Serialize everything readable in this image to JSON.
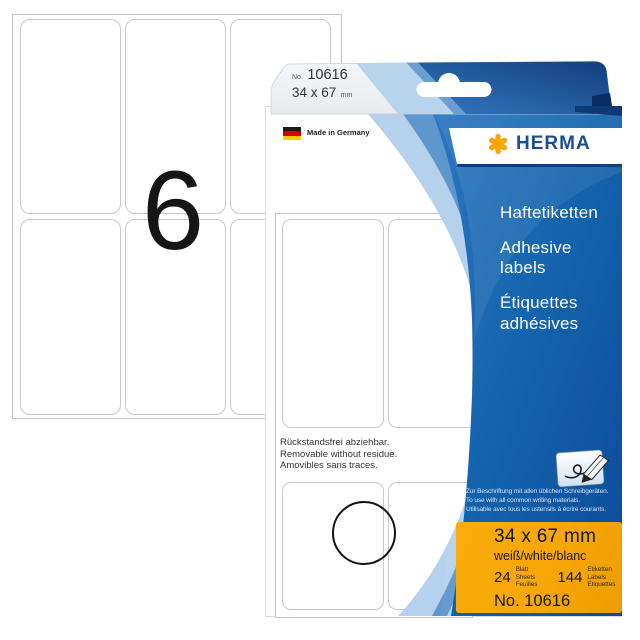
{
  "product": {
    "brand": "HERMA",
    "sheet_label_count": "6",
    "tab": {
      "no_prefix": "No.",
      "number": "10616",
      "size": "34 x 67",
      "size_unit": "mm"
    },
    "made_in": "Made in Germany",
    "titles": {
      "de": "Haftetiketten",
      "en": "Adhesive labels",
      "fr": "Étiquettes adhésives"
    },
    "window_note": [
      "Rückstandsfrei abziehbar.",
      "Removable without residue.",
      "Amovibles sans traces."
    ],
    "usage_note": [
      "Zur Beschriftung mit allen üblichen Schreibgeräten.",
      "To use with all common writing materials.",
      "Utilisable avec tous les ustensils à écrire courants."
    ],
    "spec": {
      "size": "34 x 67 mm",
      "color": "weiß/white/blanc",
      "sheets_count": "24",
      "sheets_words": [
        "Blatt",
        "Sheets",
        "Feuilles"
      ],
      "labels_count": "144",
      "labels_words": [
        "Etiketten",
        "Labels",
        "Etiquettes"
      ],
      "number": "No. 10616"
    }
  },
  "colors": {
    "panel_blue": "#1059a6",
    "light_band_blue": "#b5d1ec",
    "mid_band_blue": "#5e96ce",
    "logo_blue": "#1b4d94",
    "logo_asterisk_orange": "#f8a506",
    "box_orange": "#f7a707",
    "flag_black": "#1a1a1a",
    "flag_red": "#d60000",
    "flag_gold": "#ffcc00"
  }
}
